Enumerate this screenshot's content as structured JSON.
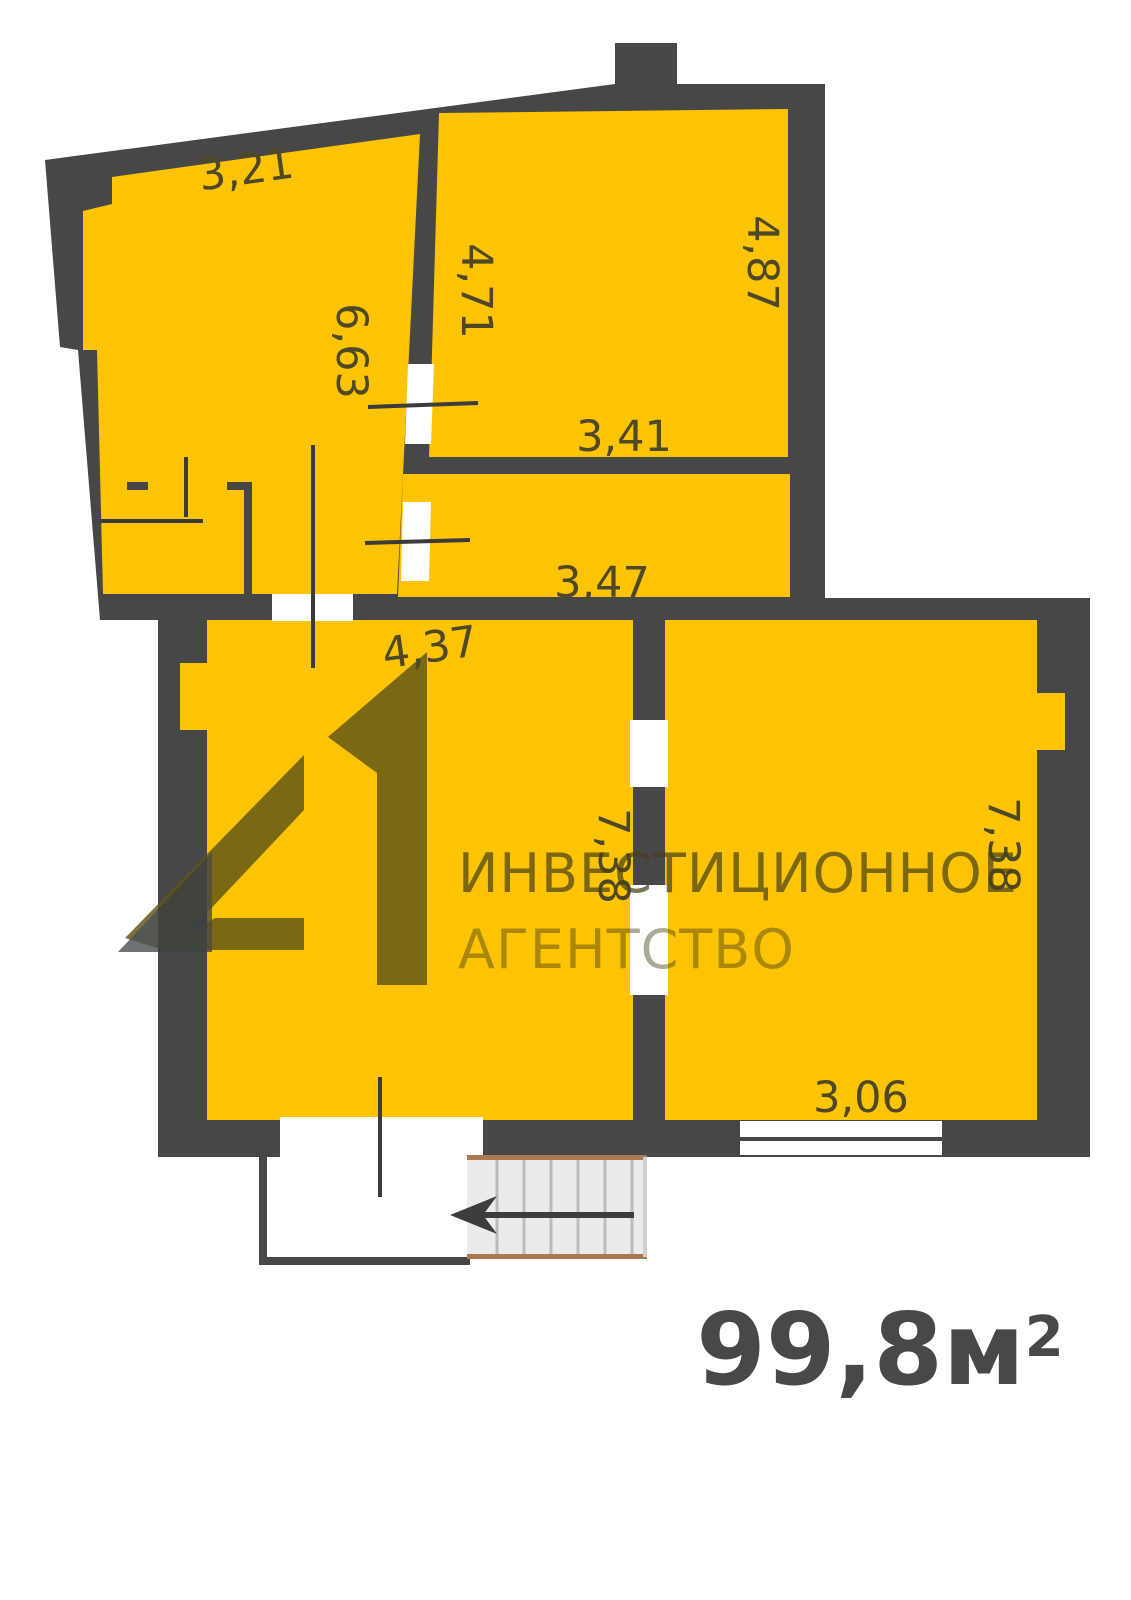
{
  "floor_plan": {
    "total_area": {
      "value": "99,8м",
      "superscript": "2"
    },
    "watermark": {
      "line1": "ИНВЕСТИЦИОННОЕ",
      "line2": "АГЕНТСТВО",
      "logo": "41-logo"
    },
    "dimensions": [
      {
        "value": "3,21",
        "room": "upper-left",
        "side": "top"
      },
      {
        "value": "4,71",
        "room": "upper-right",
        "side": "left"
      },
      {
        "value": "6,63",
        "room": "upper-left",
        "side": "right"
      },
      {
        "value": "4,87",
        "room": "upper-right",
        "side": "right"
      },
      {
        "value": "3,41",
        "room": "upper-right",
        "side": "bottom"
      },
      {
        "value": "3,47",
        "room": "corridor",
        "side": "bottom"
      },
      {
        "value": "4,37",
        "room": "lower-left",
        "side": "top"
      },
      {
        "value": "7,38",
        "room": "lower-left",
        "side": "right"
      },
      {
        "value": "7,38",
        "room": "lower-right",
        "side": "right"
      },
      {
        "value": "3,06",
        "room": "lower-right",
        "side": "bottom"
      }
    ]
  },
  "colors": {
    "wall": "#474747",
    "room": "#FDC405",
    "dimlabel": "#4e4827",
    "thinline": "#3b3b3b",
    "stairsfill": "#ebebeb",
    "stairsline": "#bcbcbc",
    "stairsedge": "#aa7a52",
    "logoolive": "#5f5517",
    "logogray": "#3b3f45",
    "arrow": "#3d3d3d",
    "areatext": "#484848",
    "wmtext1": "rgba(72,65,22,0.72)",
    "wmtext2": "rgba(72,65,22,0.45)"
  }
}
